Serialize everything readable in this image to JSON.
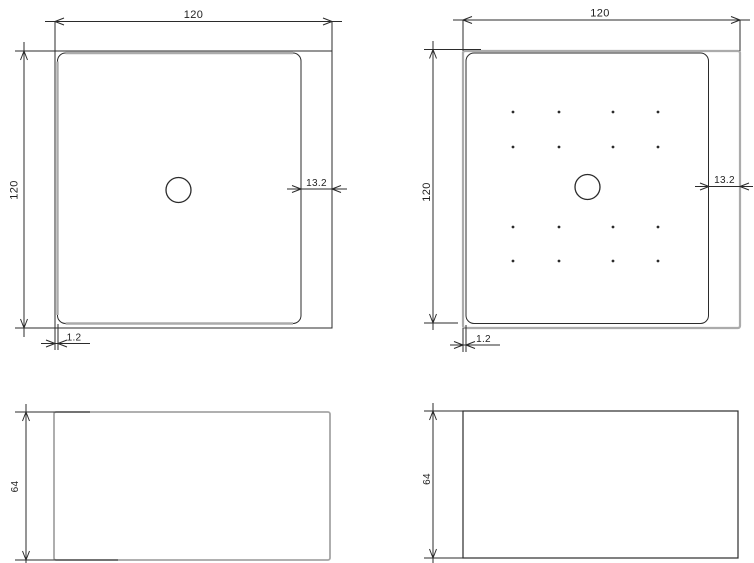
{
  "drawing": {
    "description": "Technical drawing of a square shower tray: two plan views (plain and anti-slip dotted) and two side elevation views with dimensions",
    "colors": {
      "background": "#ffffff",
      "line_dark": "#2b2b2b",
      "line_gray": "#ababab",
      "text": "#1f1f1f"
    },
    "views": {
      "plan_plain": {
        "width_label": "120",
        "height_label": "120",
        "rim_offset_label": "13.2",
        "edge_offset_label": "1.2"
      },
      "plan_dotted": {
        "width_label": "120",
        "height_label": "120",
        "rim_offset_label": "13.2",
        "edge_offset_label": "1.2",
        "dot_grid": {
          "cols": [
            513,
            559,
            613,
            658
          ],
          "rows": [
            112,
            147,
            227,
            261
          ],
          "radius": 1.4
        }
      },
      "side_left": {
        "height_label": "64"
      },
      "side_right": {
        "height_label": "64"
      }
    }
  }
}
